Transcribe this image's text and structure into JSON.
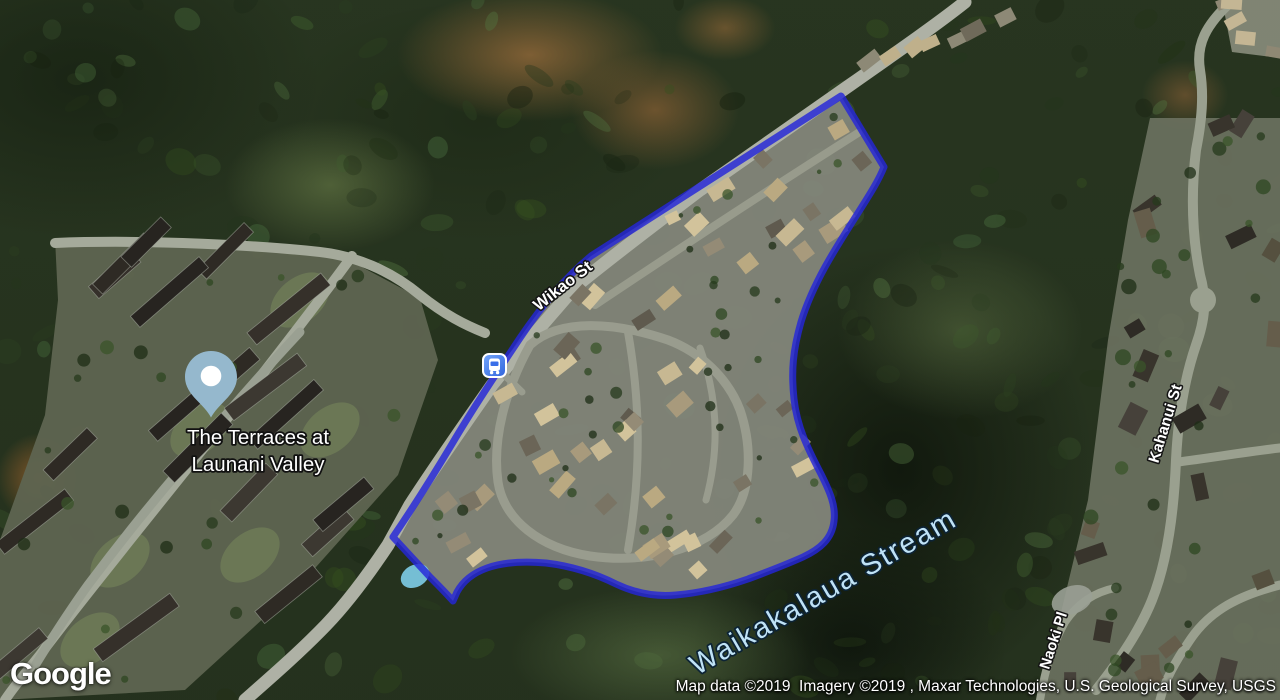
{
  "labels": {
    "street_wikao": "Wikao St",
    "street_kahanui": "Kahanui St",
    "street_naoki": "Naoki Pl",
    "water": "Waikakalaua Stream",
    "place_line1": "The Terraces at",
    "place_line2": "Launani Valley"
  },
  "markers": {
    "pin": "place-pin",
    "bus": "bus-stop-icon"
  },
  "logo": "Google",
  "attribution": "Map data ©2019  Imagery ©2019 , Maxar Technologies, U.S. Geological Survey, USGS",
  "colors": {
    "boundary": "#2526d9",
    "water_label": "#bfe2f6",
    "pin": "#95b8cd",
    "bus_top": "#74a7fb",
    "bus_bottom": "#2f63dd"
  }
}
